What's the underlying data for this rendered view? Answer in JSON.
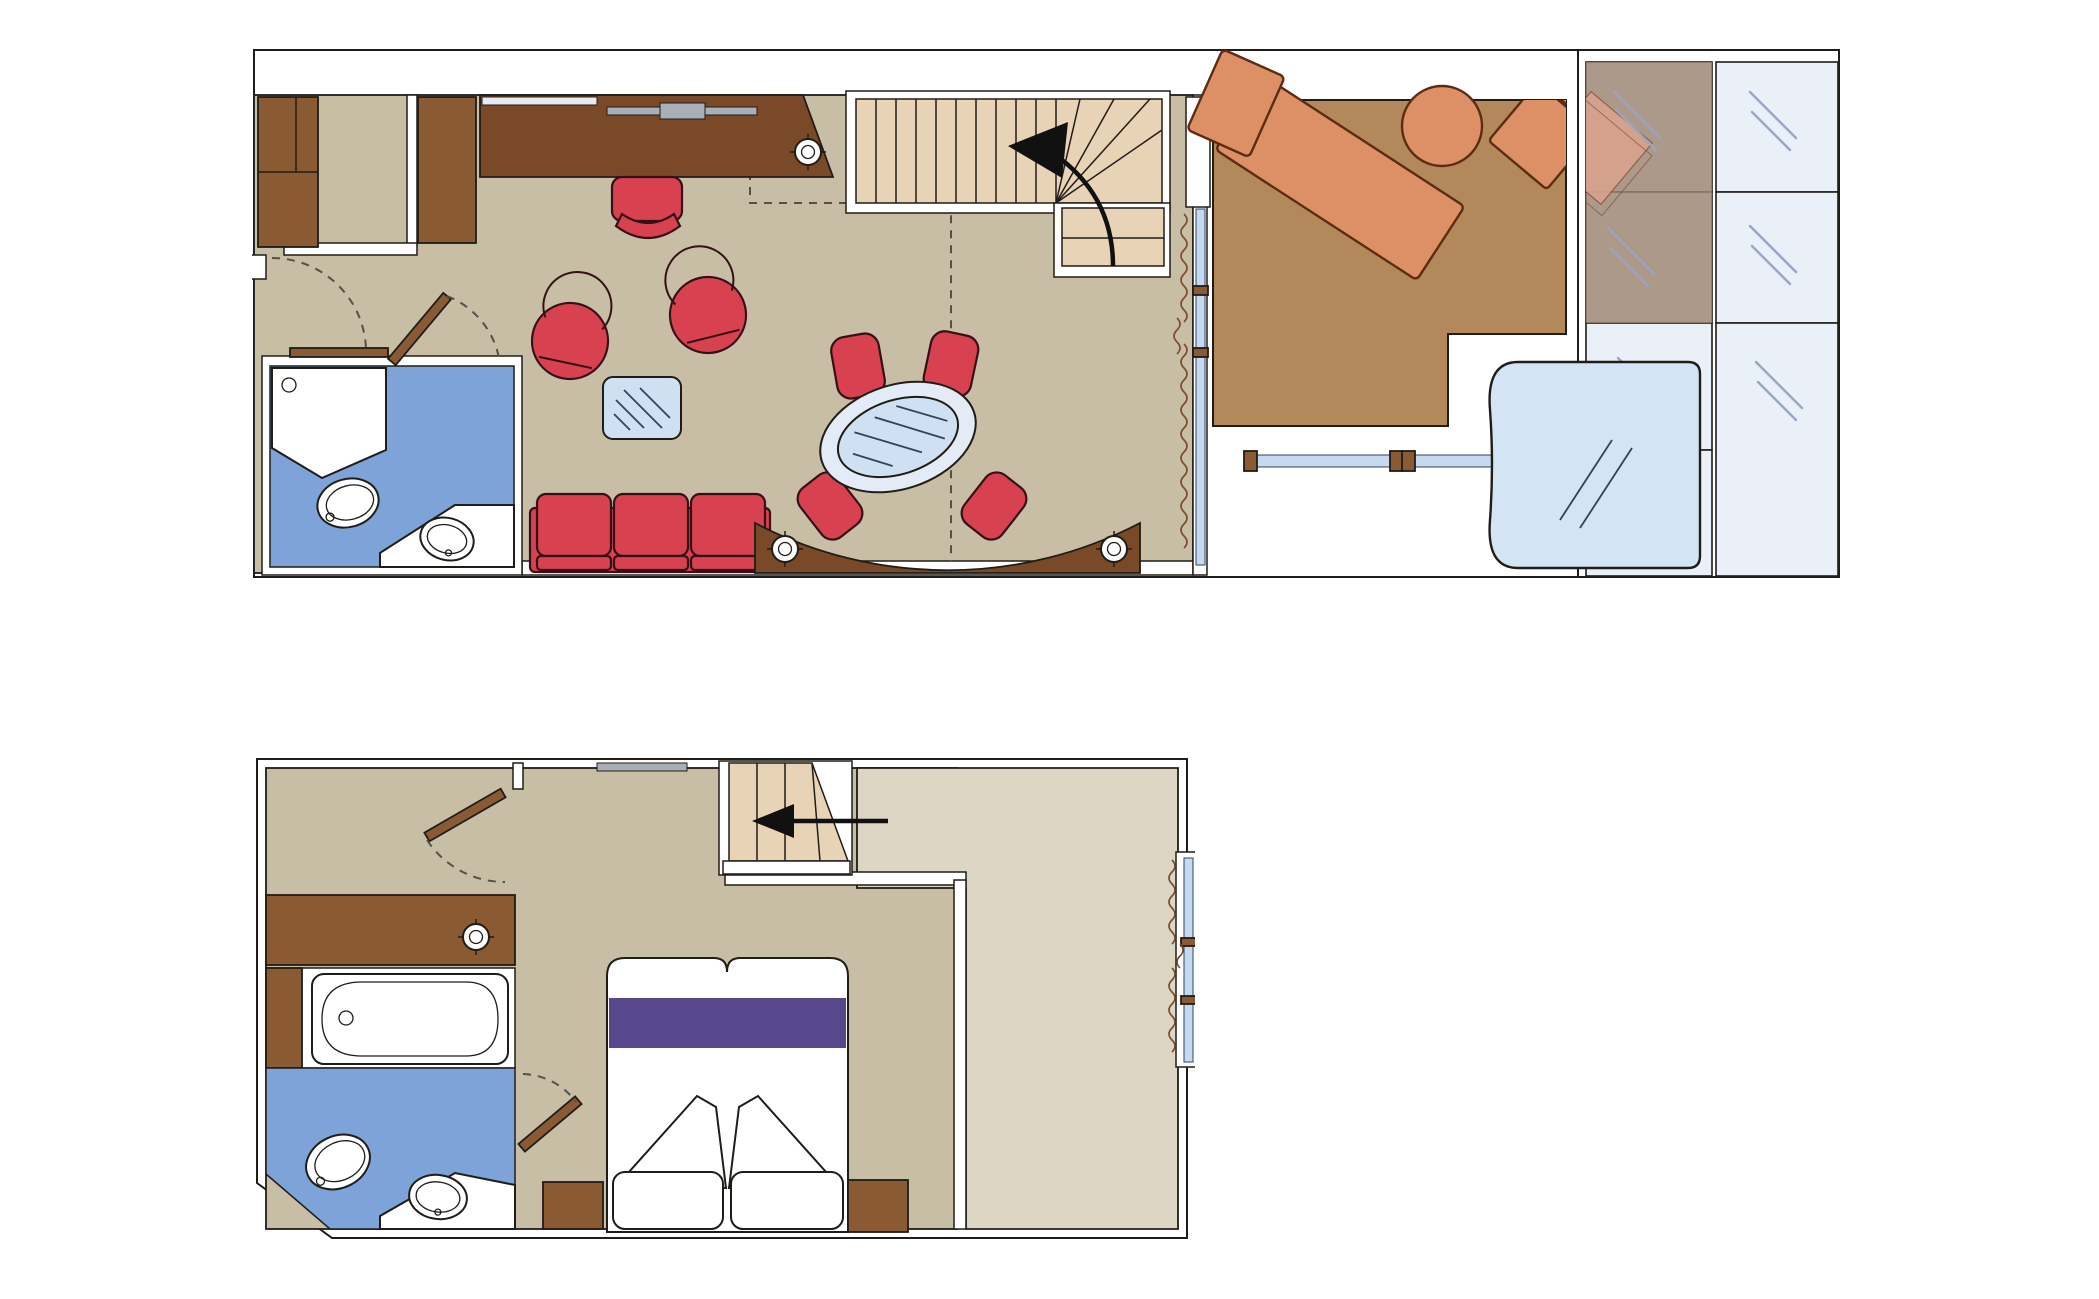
{
  "title": "duplex-suite-floor-plan",
  "palette": {
    "line": "#201c17",
    "dash": "#55504a",
    "floor": "#c8bda5",
    "floorlight": "#ddd6c4",
    "stairs": "#e9d3b7",
    "wood": "#8a5a33",
    "wooddark": "#7a4a28",
    "red": "#d8414f",
    "redline": "#351016",
    "glass": "#cfe0f2",
    "glassline": "#31415f",
    "glazing": "#c5daf0",
    "bath": "#7ea3d8",
    "deck": "#b3895c",
    "lounge": "#dd9065",
    "loungeline": "#5b2c13",
    "purple": "#57488d",
    "tub": "#d3e4f5",
    "panel": "#e9f0f8",
    "panelline": "#97a6c6",
    "tint": "#a08570",
    "ghost": "#dba38d",
    "grey": "#a9afb7",
    "greylight": "#e8eaf0"
  },
  "plans": {
    "upper": {
      "name": "upper-deck-plan",
      "rooms": [
        "entry-vestibule",
        "living-dining-room",
        "bathroom",
        "staircase-up",
        "private-balcony",
        "glass-enclosure"
      ],
      "furniture": [
        "wardrobe",
        "closet",
        "desk",
        "desk-chair",
        "tub-armchair",
        "tub-armchair",
        "coffee-table",
        "sofa",
        "dining-table",
        "dining-chairs",
        "curved-console",
        "sun-lounger",
        "round-table",
        "corner-lounge-chair",
        "whirlpool-tub",
        "toilet",
        "shower",
        "washbasin"
      ]
    },
    "lower": {
      "name": "lower-deck-plan",
      "rooms": [
        "dressing-room",
        "bedroom",
        "bathroom",
        "staircase-down",
        "open-void"
      ],
      "furniture": [
        "wardrobe",
        "bathtub",
        "toilet",
        "washbasin",
        "double-bed",
        "pillows",
        "nightstand",
        "nightstand"
      ]
    }
  }
}
